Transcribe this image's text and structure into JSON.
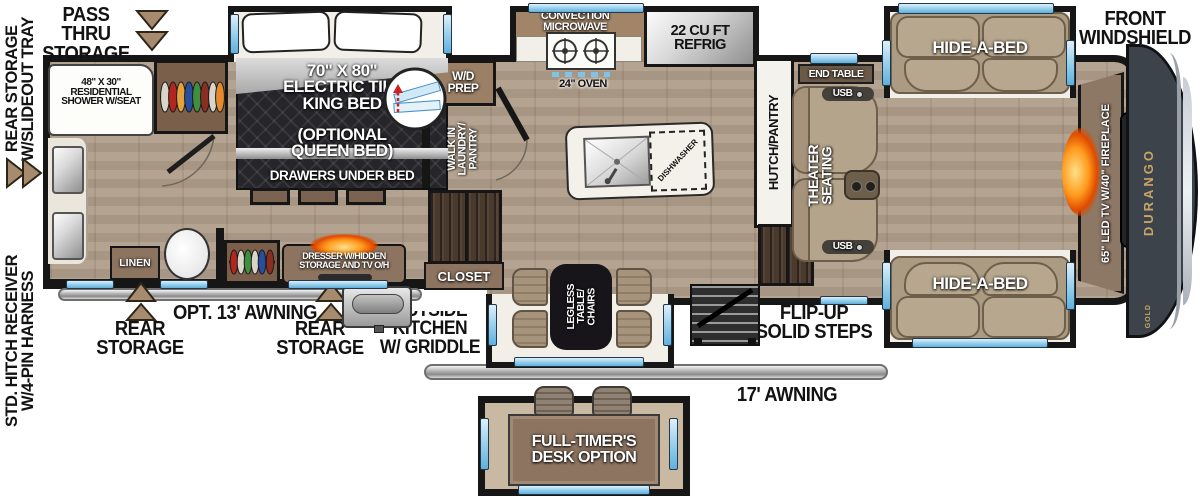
{
  "colors": {
    "wall": "#161616",
    "wood_floor": "#b09e8a",
    "window_blue": "#7fc4e8",
    "sofa_tan": "#b7a78e",
    "cabinet_brown": "#8d7460",
    "dark_wood": "#4a392d",
    "glow_orange": "#ff7a00",
    "brand_gold": "#c9a566",
    "front_cap": "#3c434b"
  },
  "exterior": {
    "rear_storage_tray": "REAR STORAGE\nW/SLIDEOUT TRAY",
    "pass_thru_storage": "PASS THRU\nSTORAGE",
    "hitch": "STD. HITCH RECEIVER\nW/4-PIN HARNESS",
    "front_windshield": "FRONT\nWINDSHIELD",
    "opt_awning": "OPT. 13' AWNING",
    "rear_storage_left": "REAR\nSTORAGE",
    "rear_storage_mid": "REAR\nSTORAGE",
    "outside_kitchen": "OUTSIDE\nKITCHEN\nW/ GRIDDLE",
    "awning_17": "17' AWNING",
    "flip_up_steps": "FLIP-UP\nSOLID STEPS"
  },
  "bathroom": {
    "shower": "48\" X 30\"\nRESIDENTIAL\nSHOWER W/SEAT",
    "linen": "LINEN"
  },
  "bedroom": {
    "bed_title": "70\" X 80\"\nELECTRIC TILT\nKING BED",
    "bed_option": "(OPTIONAL\nQUEEN BED)",
    "bed_drawers": "DRAWERS UNDER BED",
    "dresser": "DRESSER W/HIDDEN\nSTORAGE AND TV O/H"
  },
  "utility": {
    "wd_prep": "W/D\nPREP",
    "walk_in": "WALK IN\nLAUNDRY/\nPANTRY",
    "closet": "CLOSET"
  },
  "kitchen": {
    "microwave": "CONVECTION\nMICROWAVE",
    "oven": "24\" OVEN",
    "refrig": "22 CU FT\nREFRIG",
    "dishwasher": "DISHWASHER",
    "hutch": "HUTCH/PANTRY",
    "dinette": "LEGLESS\nTABLE/\nCHAIRS"
  },
  "living": {
    "end_table": "END TABLE",
    "usb_top": "USB",
    "usb_bottom": "USB",
    "theater": "THEATER\nSEATING",
    "sofa_top": "HIDE-A-BED",
    "sofa_bottom": "HIDE-A-BED",
    "tv_fireplace": "65\" LED TV W/40\" FIREPLACE"
  },
  "inset": {
    "desk": "FULL-TIMER'S\nDESK OPTION"
  },
  "brand": {
    "name": "DURANGO",
    "series": "GOLD"
  }
}
